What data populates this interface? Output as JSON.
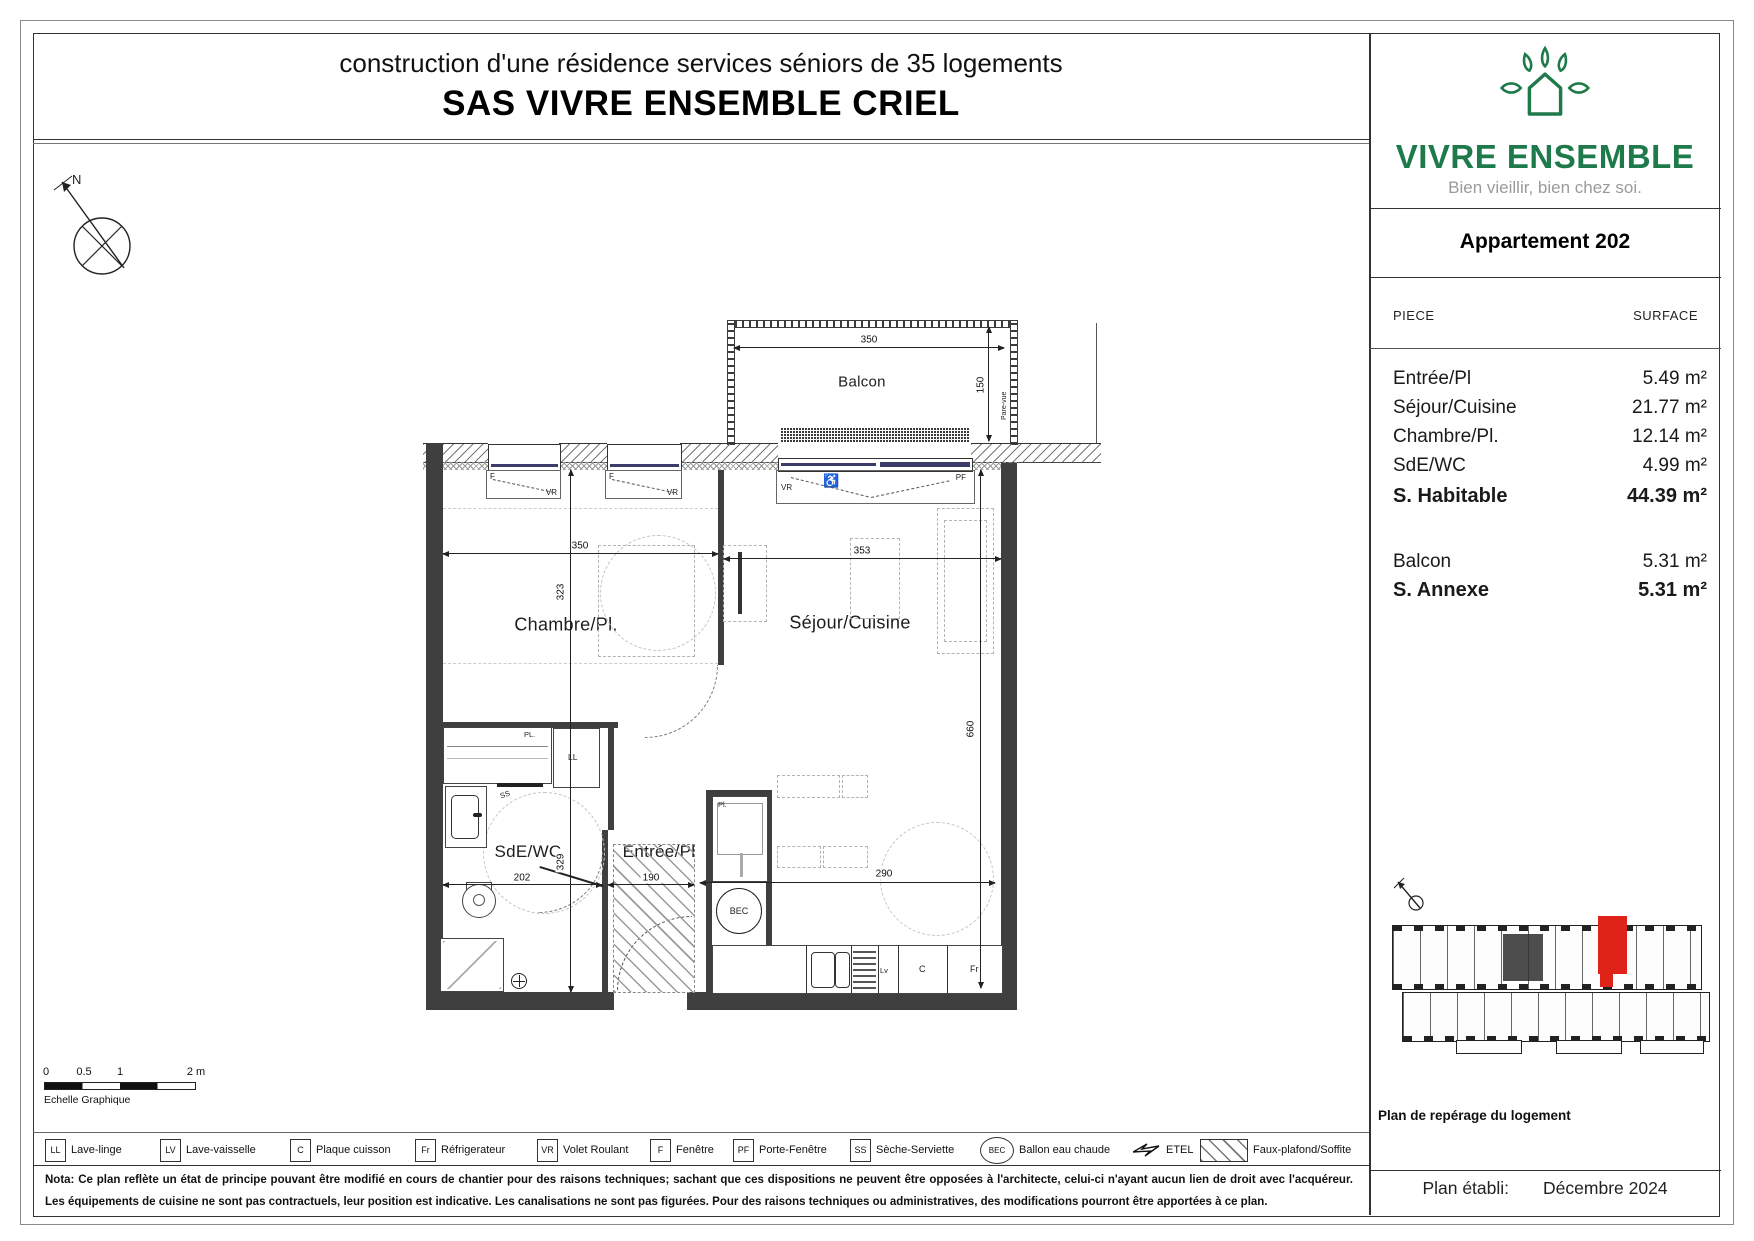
{
  "title": {
    "line1": "construction d'une résidence services séniors de 35 logements",
    "line2": "SAS VIVRE ENSEMBLE CRIEL"
  },
  "branding": {
    "name": "VIVRE ENSEMBLE",
    "tagline": "Bien vieillir, bien chez soi.",
    "green": "#1E7A4A"
  },
  "apartment": {
    "title": "Appartement 202"
  },
  "surface_table": {
    "headers": {
      "piece": "PIECE",
      "surface": "SURFACE"
    },
    "rows": [
      {
        "label": "Entrée/Pl",
        "value": "5.49 m²"
      },
      {
        "label": "Séjour/Cuisine",
        "value": "21.77 m²"
      },
      {
        "label": "Chambre/Pl.",
        "value": "12.14 m²"
      },
      {
        "label": "SdE/WC",
        "value": "4.99 m²"
      }
    ],
    "habitable": {
      "label": "S. Habitable",
      "value": "44.39 m²"
    },
    "annexe_rows": [
      {
        "label": "Balcon",
        "value": "5.31 m²"
      }
    ],
    "annexe_total": {
      "label": "S. Annexe",
      "value": "5.31 m²"
    }
  },
  "plan": {
    "rooms": {
      "balcon": "Balcon",
      "chambre": "Chambre/Pl.",
      "sejour": "Séjour/Cuisine",
      "sde": "SdE/WC",
      "entree": "Entrée/Pl"
    },
    "dims": {
      "balcony_width": "350",
      "balcony_depth": "150",
      "chambre_width": "350",
      "chambre_depth": "323",
      "sejour_width": "353",
      "sejour_depth": "660",
      "sde_width": "202",
      "sde_depth": "329",
      "entree_width": "190",
      "kitchen_width": "290"
    },
    "tags": {
      "north": "N",
      "pare_vue": "Pare-vue",
      "f": "F",
      "vr": "VR",
      "pf": "PF",
      "wheelchair": "♿",
      "pl_small": "Pl.",
      "pl_caps": "PL.",
      "ll": "LL",
      "ss": "SS",
      "bec": "BEC",
      "c": "C",
      "fr": "Fr",
      "lv": "Lv"
    }
  },
  "scale_bar": {
    "t0": "0",
    "t05": "0.5",
    "t1": "1",
    "t2": "2 m",
    "caption": "Echelle Graphique"
  },
  "legend": {
    "items": [
      {
        "symbol": "LL",
        "label": "Lave-linge"
      },
      {
        "symbol": "LV",
        "label": "Lave-vaisselle"
      },
      {
        "symbol": "C",
        "label": "Plaque cuisson"
      },
      {
        "symbol": "Fr",
        "label": "Réfrigerateur"
      },
      {
        "symbol": "VR",
        "label": "Volet Roulant"
      },
      {
        "symbol": "F",
        "label": "Fenêtre"
      },
      {
        "symbol": "PF",
        "label": "Porte-Fenêtre"
      },
      {
        "symbol": "SS",
        "label": "Sèche-Serviette"
      },
      {
        "symbol": "BEC",
        "label": "Ballon eau chaude"
      },
      {
        "symbol": "lightning",
        "label": "ETEL"
      },
      {
        "symbol": "hatch",
        "label": "Faux-plafond/Soffite"
      }
    ]
  },
  "nota": {
    "text": "Nota: Ce plan reflète un état de principe pouvant être modifié en cours de chantier pour des raisons techniques; sachant que ces dispositions ne peuvent être opposées à l'architecte, celui-ci n'ayant aucun lien de droit avec l'acquéreur. Les équipements de cuisine ne sont pas contractuels, leur position est indicative. Les canalisations ne sont pas figurées. Pour des raisons techniques ou administratives, des modifications pourront être apportées à ce plan."
  },
  "sidebar": {
    "key_plan_caption": "Plan de repérage du logement",
    "established": {
      "label": "Plan établi:",
      "date": "Décembre 2024"
    },
    "highlight_color": "#DF2318"
  }
}
